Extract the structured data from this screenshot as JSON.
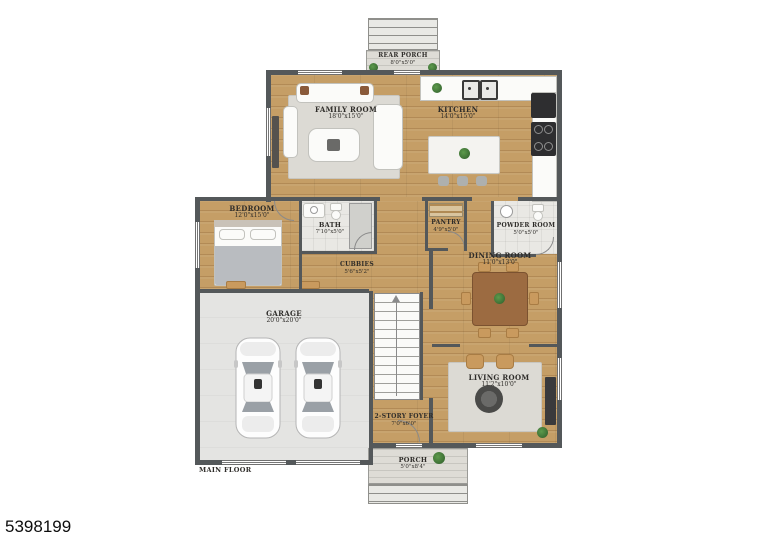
{
  "listing_id": "5398199",
  "floor_label": "MAIN FLOOR",
  "rooms": {
    "rear_porch": {
      "name": "REAR PORCH",
      "dims": "8'0\"x5'0\""
    },
    "family_room": {
      "name": "FAMILY ROOM",
      "dims": "18'0\"x15'0\""
    },
    "kitchen": {
      "name": "KITCHEN",
      "dims": "14'0\"x15'0\""
    },
    "bedroom": {
      "name": "BEDROOM",
      "dims": "12'0\"x15'0\""
    },
    "bath": {
      "name": "BATH",
      "dims": "7'10\"x5'0\""
    },
    "pantry": {
      "name": "PANTRY",
      "dims": "4'9\"x5'0\""
    },
    "powder_room": {
      "name": "POWDER ROOM",
      "dims": "5'0\"x5'0\""
    },
    "cubbies": {
      "name": "CUBBIES",
      "dims": "5'6\"x5'2\""
    },
    "dining_room": {
      "name": "DINING ROOM",
      "dims": "11'0\"x13'0\""
    },
    "garage": {
      "name": "GARAGE",
      "dims": "20'0\"x20'0\""
    },
    "living_room": {
      "name": "LIVING ROOM",
      "dims": "11'2\"x10'0\""
    },
    "foyer": {
      "name": "2-STORY FOYER",
      "dims": "7'0\"x6'0\""
    },
    "porch": {
      "name": "PORCH",
      "dims": "5'0\"x8'4\""
    }
  },
  "colors": {
    "wall": "#54585a",
    "wood_floor": "#c59e66",
    "garage_floor": "#e4e4e2",
    "porch_floor": "#dedcd6",
    "plant_green": "#3f7a3a"
  }
}
